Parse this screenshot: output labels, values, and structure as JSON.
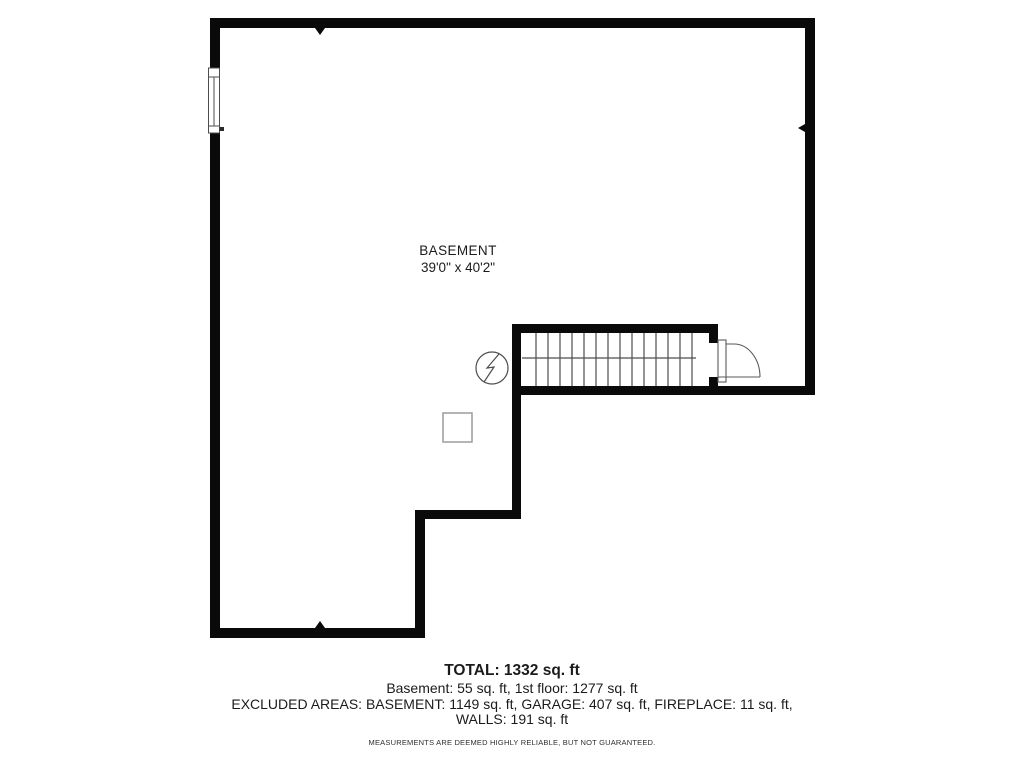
{
  "page": {
    "background": "#ffffff"
  },
  "floor_plan": {
    "room_label": "BASEMENT",
    "room_dimensions": "39'0\" x 40'2\"",
    "colors": {
      "wall": "#0a0a0a",
      "thin_line": "#4d4d4d",
      "equipment_outline": "#9c9c9c",
      "text": "#1b1b1b"
    },
    "symbols": [
      {
        "name": "window",
        "location": "upper-left-wall"
      },
      {
        "name": "staircase",
        "treads": 14,
        "location": "middle-right"
      },
      {
        "name": "door-swing",
        "location": "right-of-staircase"
      },
      {
        "name": "electrical-panel",
        "location": "left-of-staircase"
      },
      {
        "name": "equipment-square",
        "location": "center"
      },
      {
        "name": "wall-marker-top",
        "location": "top-wall"
      },
      {
        "name": "wall-marker-right",
        "location": "right-wall"
      },
      {
        "name": "wall-marker-bottom",
        "location": "bottom-wall"
      }
    ]
  },
  "summary": {
    "total_line": "TOTAL: 1332 sq. ft",
    "floors_line": "Basement: 55 sq. ft, 1st floor: 1277 sq. ft",
    "excluded_line": "EXCLUDED AREAS: BASEMENT: 1149 sq. ft, GARAGE: 407 sq. ft, FIREPLACE: 11 sq. ft,",
    "walls_line": "WALLS: 191 sq. ft",
    "disclaimer": "MEASUREMENTS ARE DEEMED HIGHLY RELIABLE, BUT NOT GUARANTEED.",
    "areas": {
      "total_sqft": 1332,
      "basement_sqft": 55,
      "first_floor_sqft": 1277,
      "excluded_basement_sqft": 1149,
      "excluded_garage_sqft": 407,
      "excluded_fireplace_sqft": 11,
      "excluded_walls_sqft": 191
    }
  }
}
